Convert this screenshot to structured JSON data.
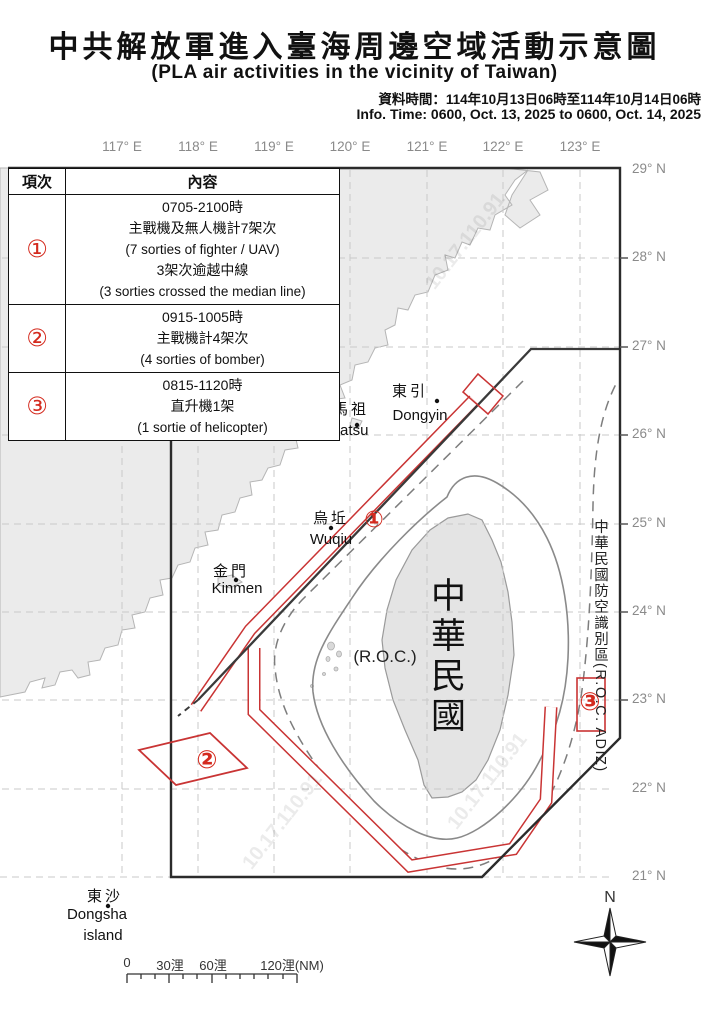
{
  "title": {
    "zh": "中共解放軍進入臺海周邊空域活動示意圖",
    "en": "(PLA air activities in the vicinity of Taiwan)",
    "time_zh": "資料時間：114年10月13日06時至114年10月14日06時",
    "time_en": "Info. Time: 0600, Oct. 13, 2025 to 0600, Oct. 14, 2025"
  },
  "table": {
    "headers": {
      "item": "項次",
      "content": "內容"
    },
    "rows": [
      {
        "no": "①",
        "lines": [
          "0705-2100時",
          "主戰機及無人機計7架次",
          "(7 sorties of fighter / UAV)",
          "3架次逾越中線",
          "(3 sorties crossed the median line)"
        ]
      },
      {
        "no": "②",
        "lines": [
          "0915-1005時",
          "主戰機計4架次",
          "(4 sorties of bomber)"
        ]
      },
      {
        "no": "③",
        "lines": [
          "0815-1120時",
          "直升機1架",
          "(1 sortie of helicopter)"
        ]
      }
    ]
  },
  "map": {
    "lon_labels": [
      "117° E",
      "118° E",
      "119° E",
      "120° E",
      "121° E",
      "122° E",
      "123° E"
    ],
    "lat_labels": [
      "29° N",
      "28° N",
      "27° N",
      "26° N",
      "25° N",
      "24° N",
      "23° N",
      "22° N",
      "21° N"
    ],
    "places": {
      "dongyin_zh": "東引",
      "dongyin_en": "Dongyin",
      "matsu_zh": "馬祖",
      "matsu_en": "Matsu",
      "wuqiu_zh": "烏坵",
      "wuqiu_en": "Wuqiu",
      "kinmen_zh": "金門",
      "kinmen_en": "Kinmen",
      "dongsha_zh": "東沙",
      "dongsha_en1": "Dongsha",
      "dongsha_en2": "island"
    },
    "taiwan_zh": "中華民國",
    "taiwan_en": "(R.O.C.)",
    "adiz_label": "中華民國防空識別區(R.O.C. ADIZ)",
    "markers": [
      "①",
      "②",
      "③"
    ],
    "watermark": "10.17.110.91"
  },
  "scale": {
    "ticks": [
      "0",
      "30浬",
      "60浬",
      "120浬(NM)"
    ]
  },
  "compass": {
    "north": "N"
  },
  "colors": {
    "activity_red": "#c93434",
    "marker_red": "#d42a1e",
    "land_fill": "#ebebeb",
    "taiwan_fill": "#e4e4e4",
    "frame_black": "#2b2b2b",
    "median_line": "#3a3a3a",
    "grid_gray": "#c9c9c9",
    "label_gray": "#8a8a8a"
  }
}
